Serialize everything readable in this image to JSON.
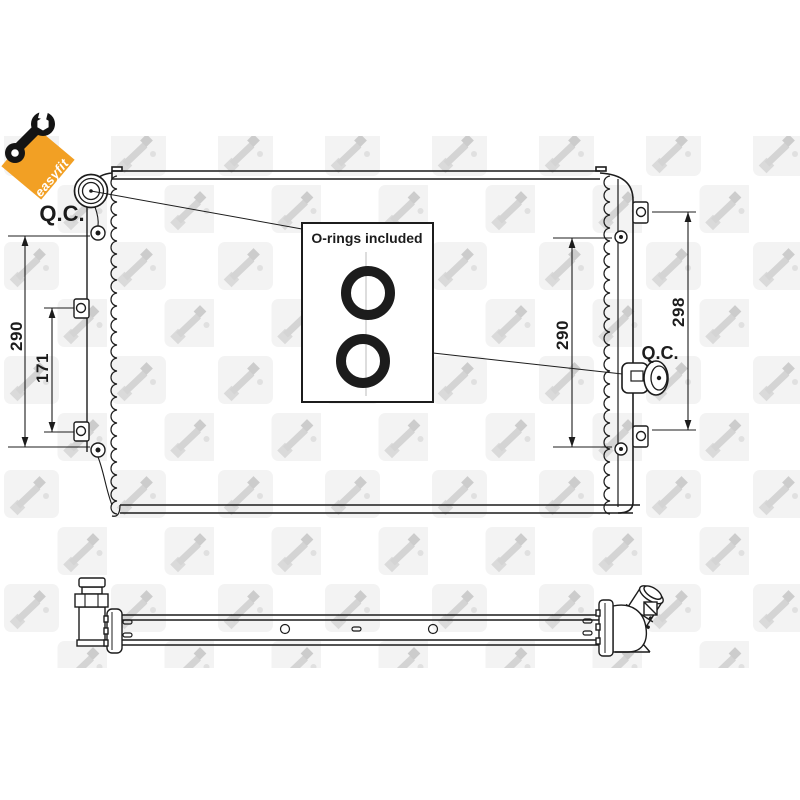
{
  "image": {
    "badge": {
      "text": "easyfit",
      "color": "#F2A024"
    },
    "note_box": {
      "title": "O-rings included"
    },
    "labels": {
      "qc_left": "Q.C.",
      "qc_right": "Q.C."
    },
    "dimensions": {
      "left_outer": "290",
      "left_inner": "171",
      "right_inner": "290",
      "right_outer": "298"
    },
    "colors": {
      "line": "#1c1c1c",
      "badge_orange": "#F2A024",
      "watermark_tile": "#f3f3f3",
      "watermark_glyph": "#d6d6d6"
    }
  }
}
